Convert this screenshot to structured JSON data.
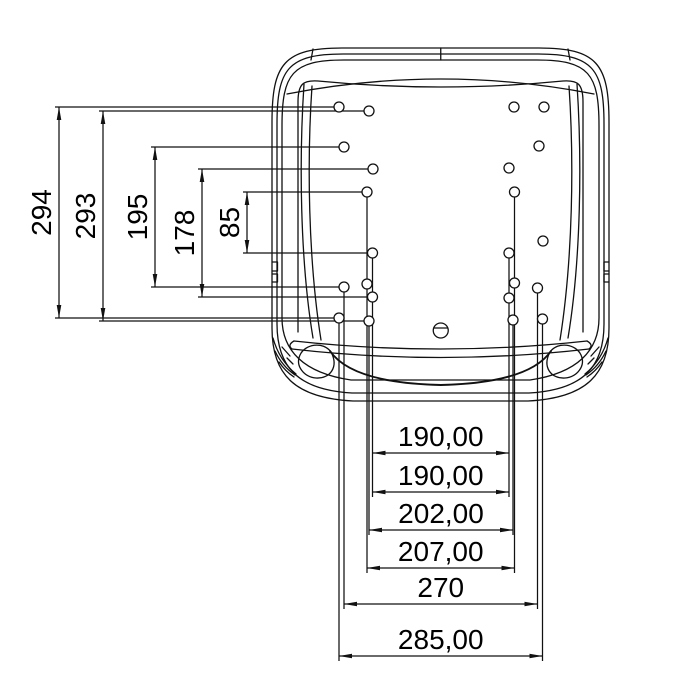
{
  "drawing": {
    "type": "technical-drawing",
    "subject": "seat-pan-mounting-hole-pattern-top-view",
    "background_color": "#ffffff",
    "line_color": "#111111",
    "canvas": {
      "width": 700,
      "height": 700
    },
    "vertical_dimensions": [
      {
        "label": "294",
        "x": 59,
        "y1": 107,
        "y2": 318
      },
      {
        "label": "293",
        "x": 103,
        "y1": 111,
        "y2": 321
      },
      {
        "label": "195",
        "x": 155,
        "y1": 147,
        "y2": 287
      },
      {
        "label": "178",
        "x": 202,
        "y1": 169,
        "y2": 297
      },
      {
        "label": "85",
        "x": 247,
        "y1": 192,
        "y2": 253
      }
    ],
    "horizontal_dimensions": [
      {
        "label": "190,00",
        "y": 453,
        "x1": 372.5,
        "x2": 509
      },
      {
        "label": "190,00",
        "y": 492,
        "x1": 372.5,
        "x2": 509
      },
      {
        "label": "202,00",
        "y": 530,
        "x1": 369,
        "x2": 513
      },
      {
        "label": "207,00",
        "y": 568,
        "x1": 367,
        "x2": 514.5
      },
      {
        "label": "270",
        "y": 604,
        "x1": 344,
        "x2": 537.5
      },
      {
        "label": "285,00",
        "y": 656,
        "x1": 339,
        "x2": 542.5
      }
    ],
    "h_extension_lines": [
      {
        "y": 107,
        "x1": 55,
        "x2": 334.5
      },
      {
        "y": 111,
        "x1": 99,
        "x2": 364
      },
      {
        "y": 147,
        "x1": 151,
        "x2": 339
      },
      {
        "y": 169,
        "x1": 198,
        "x2": 368
      },
      {
        "y": 192,
        "x1": 243,
        "x2": 362
      },
      {
        "y": 253,
        "x1": 243,
        "x2": 367.5
      },
      {
        "y": 287,
        "x1": 151,
        "x2": 339
      },
      {
        "y": 297,
        "x1": 198,
        "x2": 367.5
      },
      {
        "y": 318,
        "x1": 55,
        "x2": 334
      },
      {
        "y": 321,
        "x1": 99,
        "x2": 364
      }
    ],
    "v_extension_lines": [
      {
        "x": 372.5,
        "y1": 258,
        "y2": 497
      },
      {
        "x": 509,
        "y1": 258,
        "y2": 497
      },
      {
        "x": 369,
        "y1": 326,
        "y2": 535
      },
      {
        "x": 513,
        "y1": 325,
        "y2": 535
      },
      {
        "x": 367,
        "y1": 197,
        "y2": 573
      },
      {
        "x": 514.5,
        "y1": 197,
        "y2": 573
      },
      {
        "x": 344,
        "y1": 292,
        "y2": 609
      },
      {
        "x": 537.5,
        "y1": 293,
        "y2": 609
      },
      {
        "x": 339,
        "y1": 323,
        "y2": 661
      },
      {
        "x": 542.5,
        "y1": 324,
        "y2": 661
      }
    ],
    "holes": [
      {
        "cx": 339,
        "cy": 107,
        "r": 5
      },
      {
        "cx": 369,
        "cy": 111,
        "r": 5
      },
      {
        "cx": 344,
        "cy": 147,
        "r": 5
      },
      {
        "cx": 373,
        "cy": 169,
        "r": 5
      },
      {
        "cx": 367,
        "cy": 192,
        "r": 5
      },
      {
        "cx": 372.5,
        "cy": 253,
        "r": 5
      },
      {
        "cx": 367,
        "cy": 284,
        "r": 5
      },
      {
        "cx": 344,
        "cy": 287,
        "r": 5
      },
      {
        "cx": 372.5,
        "cy": 297,
        "r": 5
      },
      {
        "cx": 339,
        "cy": 318,
        "r": 5
      },
      {
        "cx": 369,
        "cy": 321,
        "r": 5
      },
      {
        "cx": 514,
        "cy": 107,
        "r": 5
      },
      {
        "cx": 544,
        "cy": 107,
        "r": 5
      },
      {
        "cx": 539,
        "cy": 146,
        "r": 5
      },
      {
        "cx": 509,
        "cy": 168,
        "r": 5
      },
      {
        "cx": 514.5,
        "cy": 192,
        "r": 5
      },
      {
        "cx": 543,
        "cy": 241,
        "r": 5
      },
      {
        "cx": 509,
        "cy": 253,
        "r": 5
      },
      {
        "cx": 514.5,
        "cy": 283,
        "r": 5
      },
      {
        "cx": 537.5,
        "cy": 288,
        "r": 5
      },
      {
        "cx": 509,
        "cy": 298,
        "r": 5
      },
      {
        "cx": 542.5,
        "cy": 319,
        "r": 5
      },
      {
        "cx": 513,
        "cy": 320,
        "r": 5
      }
    ],
    "center_feature": {
      "cx": 440.75,
      "cy": 330.5,
      "r": 7.5,
      "chord_y": 328
    },
    "arrow": {
      "length": 13,
      "half_width": 2.3
    },
    "dim_font_size": 28
  }
}
